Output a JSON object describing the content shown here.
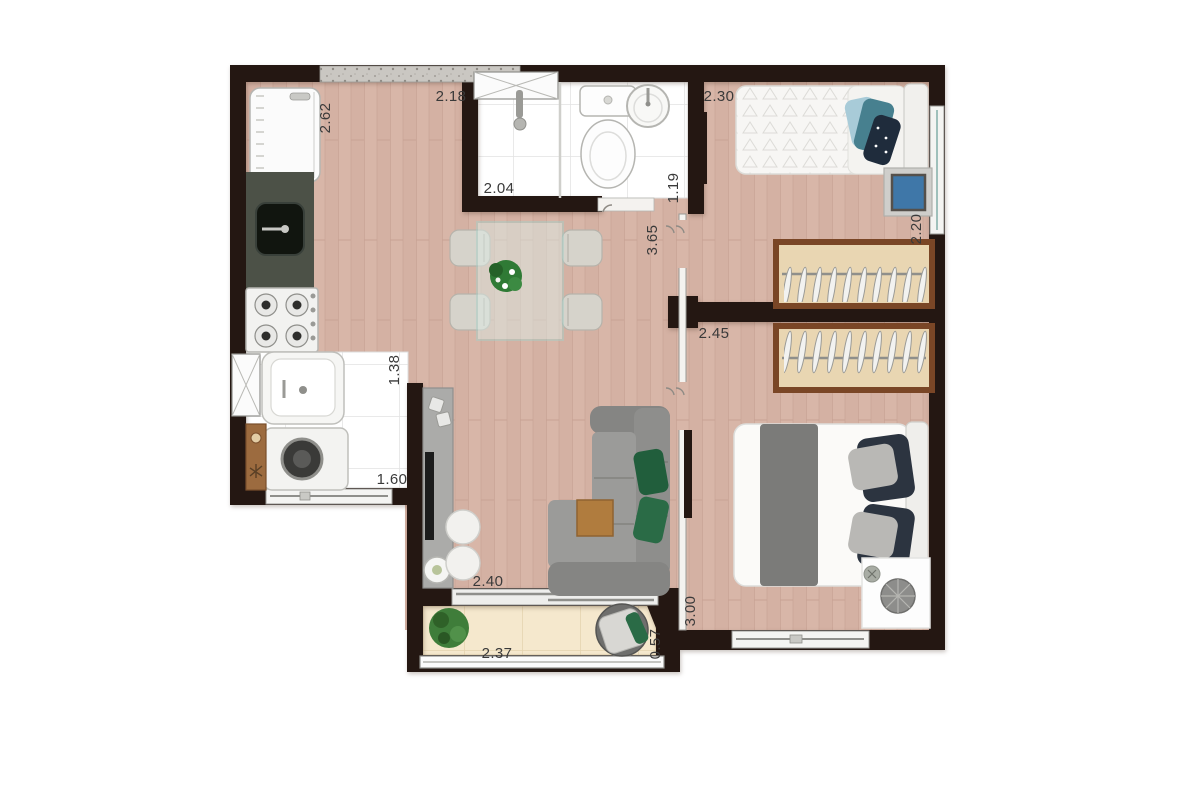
{
  "plan": {
    "type": "apartment-floor-plan",
    "unit_hint": "meters",
    "dimensions": {
      "kitchen_depth": {
        "value": "2.62",
        "room": "kitchen",
        "orientation": "vertical"
      },
      "kitchen_width": {
        "value": "2.18",
        "room": "kitchen",
        "orientation": "horizontal"
      },
      "bathroom_length": {
        "value": "2.04",
        "room": "bathroom",
        "orientation": "horizontal"
      },
      "bathroom_width": {
        "value": "1.19",
        "room": "bathroom",
        "orientation": "vertical"
      },
      "bedroom1_width": {
        "value": "2.30",
        "room": "bedroom-1",
        "orientation": "horizontal"
      },
      "bedroom1_depth": {
        "value": "2.20",
        "room": "bedroom-1",
        "orientation": "vertical"
      },
      "hall_length": {
        "value": "3.65",
        "room": "hall",
        "orientation": "vertical"
      },
      "bedroom2_width": {
        "value": "2.45",
        "room": "bedroom-2",
        "orientation": "horizontal"
      },
      "laundry_depth": {
        "value": "1.38",
        "room": "laundry",
        "orientation": "vertical"
      },
      "laundry_width": {
        "value": "1.60",
        "room": "laundry",
        "orientation": "horizontal"
      },
      "living_width": {
        "value": "2.40",
        "room": "living-room",
        "orientation": "horizontal"
      },
      "bedroom2_depth": {
        "value": "3.00",
        "room": "bedroom-2",
        "orientation": "vertical"
      },
      "balcony_width": {
        "value": "2.37",
        "room": "balcony",
        "orientation": "horizontal"
      },
      "balcony_depth": {
        "value": "0.57",
        "room": "balcony",
        "orientation": "vertical"
      }
    },
    "colors": {
      "wall": "#241712",
      "wood_floor": "#d8b6a8",
      "tile_floor": "#ffffff",
      "balcony_floor": "#f5e8cd",
      "counter_granite": "#4c5147",
      "wardrobe_frame": "#7a4626",
      "wardrobe_fill": "#e9d6b2",
      "sofa_gray": "#8e8e8c",
      "pillow_green": "#215e3c",
      "pillow_teal": "#47808f",
      "pillow_navy": "#2c3440",
      "tv_screen_blue": "#3f77a8",
      "wood_furniture": "#b07c3e",
      "label_text": "#3a3a3a"
    }
  }
}
